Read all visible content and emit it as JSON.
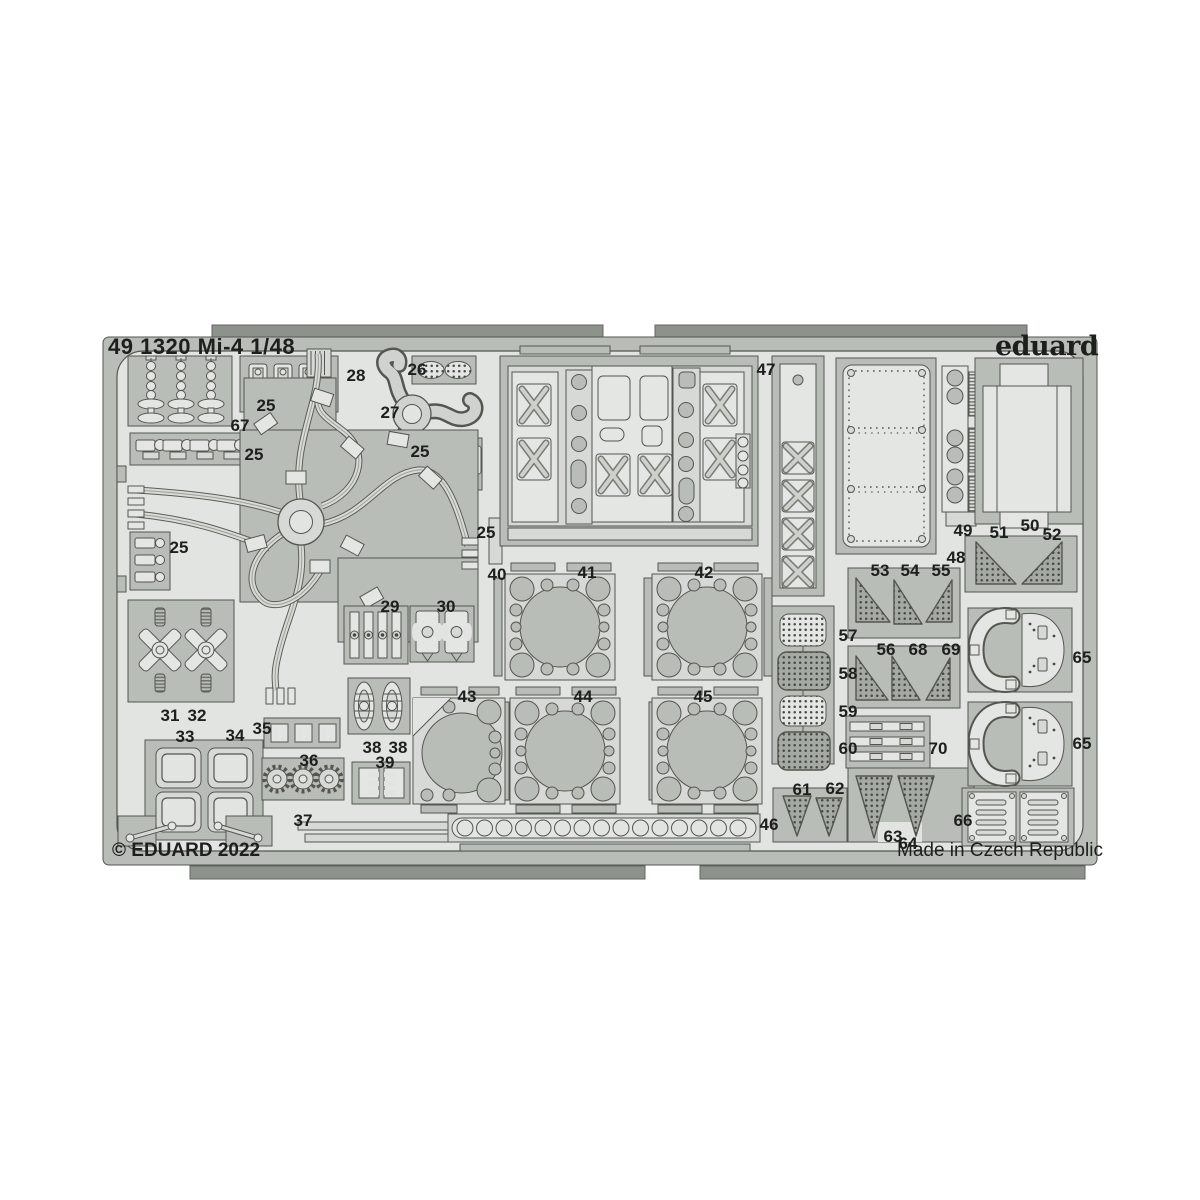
{
  "sheet": {
    "title": "49 1320 Mi-4 1/48",
    "brand": "eduard",
    "copyright": "© EDUARD 2022",
    "made_in": "Made in Czech Republic",
    "scale": "1/48",
    "subject": "Mi-4",
    "product_number": "49 1320"
  },
  "colors": {
    "background": "#ffffff",
    "fret_base": "#e2e4e1",
    "plate": "#b9bdb8",
    "part": "#d6d9d5",
    "part_light": "#e4e6e3",
    "outline": "#53574f",
    "mesh_base": "#a5a9a4",
    "tab": "#8d928c",
    "text": "#1d1f1d"
  },
  "part_labels": [
    {
      "text": "67",
      "x": 240,
      "y": 426
    },
    {
      "text": "25",
      "x": 266,
      "y": 406
    },
    {
      "text": "25",
      "x": 254,
      "y": 455
    },
    {
      "text": "25",
      "x": 420,
      "y": 452
    },
    {
      "text": "25",
      "x": 486,
      "y": 533
    },
    {
      "text": "25",
      "x": 179,
      "y": 548
    },
    {
      "text": "26",
      "x": 417,
      "y": 370
    },
    {
      "text": "27",
      "x": 390,
      "y": 413
    },
    {
      "text": "28",
      "x": 356,
      "y": 376
    },
    {
      "text": "29",
      "x": 390,
      "y": 607
    },
    {
      "text": "30",
      "x": 446,
      "y": 607
    },
    {
      "text": "31",
      "x": 170,
      "y": 716
    },
    {
      "text": "32",
      "x": 197,
      "y": 716
    },
    {
      "text": "33",
      "x": 185,
      "y": 737
    },
    {
      "text": "34",
      "x": 235,
      "y": 736
    },
    {
      "text": "35",
      "x": 262,
      "y": 729
    },
    {
      "text": "36",
      "x": 309,
      "y": 761
    },
    {
      "text": "37",
      "x": 303,
      "y": 821
    },
    {
      "text": "38",
      "x": 372,
      "y": 748
    },
    {
      "text": "38",
      "x": 398,
      "y": 748
    },
    {
      "text": "39",
      "x": 385,
      "y": 763
    },
    {
      "text": "40",
      "x": 497,
      "y": 575
    },
    {
      "text": "41",
      "x": 587,
      "y": 573
    },
    {
      "text": "42",
      "x": 704,
      "y": 573
    },
    {
      "text": "43",
      "x": 467,
      "y": 697
    },
    {
      "text": "44",
      "x": 583,
      "y": 697
    },
    {
      "text": "45",
      "x": 703,
      "y": 697
    },
    {
      "text": "46",
      "x": 769,
      "y": 825
    },
    {
      "text": "47",
      "x": 766,
      "y": 370
    },
    {
      "text": "48",
      "x": 956,
      "y": 558
    },
    {
      "text": "49",
      "x": 963,
      "y": 531
    },
    {
      "text": "50",
      "x": 1030,
      "y": 526
    },
    {
      "text": "51",
      "x": 999,
      "y": 533
    },
    {
      "text": "52",
      "x": 1052,
      "y": 535
    },
    {
      "text": "53",
      "x": 880,
      "y": 571
    },
    {
      "text": "54",
      "x": 910,
      "y": 571
    },
    {
      "text": "55",
      "x": 941,
      "y": 571
    },
    {
      "text": "56",
      "x": 886,
      "y": 650
    },
    {
      "text": "68",
      "x": 918,
      "y": 650
    },
    {
      "text": "69",
      "x": 951,
      "y": 650
    },
    {
      "text": "57",
      "x": 848,
      "y": 636
    },
    {
      "text": "58",
      "x": 848,
      "y": 674
    },
    {
      "text": "59",
      "x": 848,
      "y": 712
    },
    {
      "text": "60",
      "x": 848,
      "y": 749
    },
    {
      "text": "70",
      "x": 938,
      "y": 749
    },
    {
      "text": "61",
      "x": 802,
      "y": 790
    },
    {
      "text": "62",
      "x": 835,
      "y": 789
    },
    {
      "text": "63",
      "x": 893,
      "y": 837
    },
    {
      "text": "64",
      "x": 908,
      "y": 844
    },
    {
      "text": "65",
      "x": 1082,
      "y": 658
    },
    {
      "text": "65",
      "x": 1082,
      "y": 744
    },
    {
      "text": "66",
      "x": 963,
      "y": 821
    }
  ]
}
